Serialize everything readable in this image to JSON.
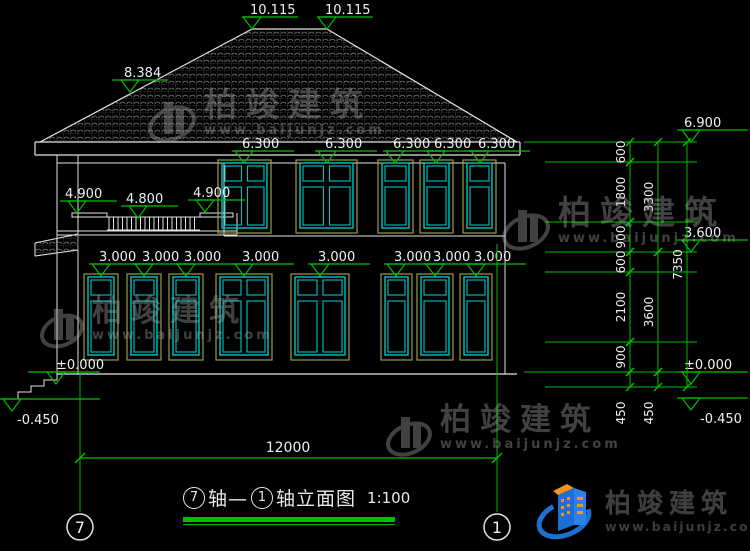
{
  "colors": {
    "background": "#000000",
    "line": "#e2e2e2",
    "annotation_green": "#00be00",
    "window_frame_cyan": "#00c4c4",
    "window_trim_yellow": "#9c9c4a",
    "text_white": "#f0f0f0",
    "roof_hatch_gray": "#6e6e6e",
    "watermark_gray": "#aaaaaa",
    "logo_blue": "#1d6fd2",
    "logo_orange": "#f7941d",
    "logo_text_gray": "#3f3f3f"
  },
  "watermark": {
    "brand": "柏竣建筑",
    "site": "www.baijunjz.com"
  },
  "brand_logo": {
    "brand": "柏竣建筑",
    "site": "www.baijunjz.com"
  },
  "title": {
    "axis_from": "7",
    "joiner": "轴—",
    "axis_to": "1",
    "name": "轴立面图",
    "scale": "1:100"
  },
  "axis_grid": {
    "left_bubble": "7",
    "right_bubble": "1",
    "overall_dim": "12000"
  },
  "elevation_marks": {
    "ridge": [
      {
        "label": "10.115",
        "x": 252,
        "level": 29
      },
      {
        "label": "10.115",
        "x": 327,
        "level": 29
      }
    ],
    "roof_slope": [
      {
        "label": "8.384",
        "x": 130,
        "level": 92
      }
    ],
    "upper_windows": {
      "label": "6.300",
      "level": 163,
      "centers": [
        244,
        327,
        395,
        436,
        480
      ]
    },
    "balcony": [
      {
        "label": "4.900",
        "x": 77,
        "level": 213
      },
      {
        "label": "4.800",
        "x": 138,
        "level": 218
      },
      {
        "label": "4.900",
        "x": 205,
        "level": 212
      }
    ],
    "lower_windows": {
      "label": "3.000",
      "level": 276,
      "centers": [
        101,
        144,
        186,
        244,
        320,
        396,
        435,
        476
      ]
    },
    "left": [
      {
        "label": "±0.000",
        "x": 56,
        "level": 384
      },
      {
        "label": "-0.450",
        "x": 12,
        "level": 411,
        "below": true
      }
    ],
    "right": [
      {
        "label": "6.900",
        "level": 142
      },
      {
        "label": "3.600",
        "level": 252
      },
      {
        "label": "±0.000",
        "level": 384
      },
      {
        "label": "-0.450",
        "level": 410,
        "below": true
      }
    ]
  },
  "dimension_chains": [
    {
      "x": 630,
      "segments": [
        [
          "600",
          142,
          162
        ],
        [
          "1800",
          162,
          222
        ],
        [
          "900",
          222,
          252
        ],
        [
          "600",
          252,
          272
        ],
        [
          "2100",
          272,
          342
        ],
        [
          "900",
          342,
          372
        ],
        [
          "450",
          372,
          387,
          413
        ]
      ]
    },
    {
      "x": 658,
      "segments": [
        [
          "3300",
          142,
          252
        ],
        [
          "3600",
          252,
          372
        ],
        [
          "450",
          372,
          387,
          413
        ]
      ]
    },
    {
      "x": 687,
      "segments": [
        [
          "7350",
          142,
          387
        ]
      ]
    }
  ],
  "extension_levels": [
    142,
    162,
    222,
    252,
    272,
    342,
    372,
    387
  ]
}
